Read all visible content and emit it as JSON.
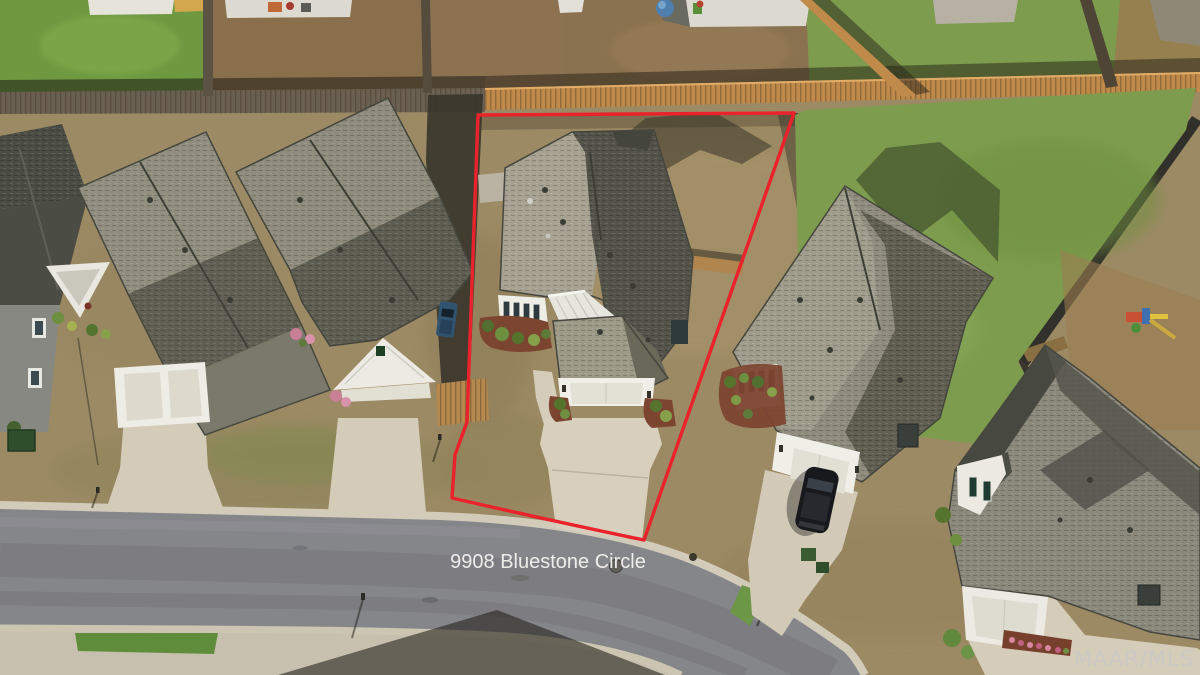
{
  "photo": {
    "kind": "aerial-drone-photo",
    "description": "Overhead drone view of a suburban cul-de-sac lot outlined in red",
    "address_label": "9908 Bluestone Circle",
    "watermark": "MAAR/MLS",
    "boundary_color": "#e9222b",
    "label_color": "#f4f3ef",
    "watermark_color": "#c9c9c9",
    "palette": {
      "lawn_tan": "#9c8a64",
      "lawn_green": "#7d9c4d",
      "roof_light": "#a39f8f",
      "roof_dark": "#54544a",
      "asphalt": "#85868a",
      "concrete": "#d3cab7",
      "fence_sunlit": "#c08a4b",
      "mulch": "#7c4530"
    }
  }
}
